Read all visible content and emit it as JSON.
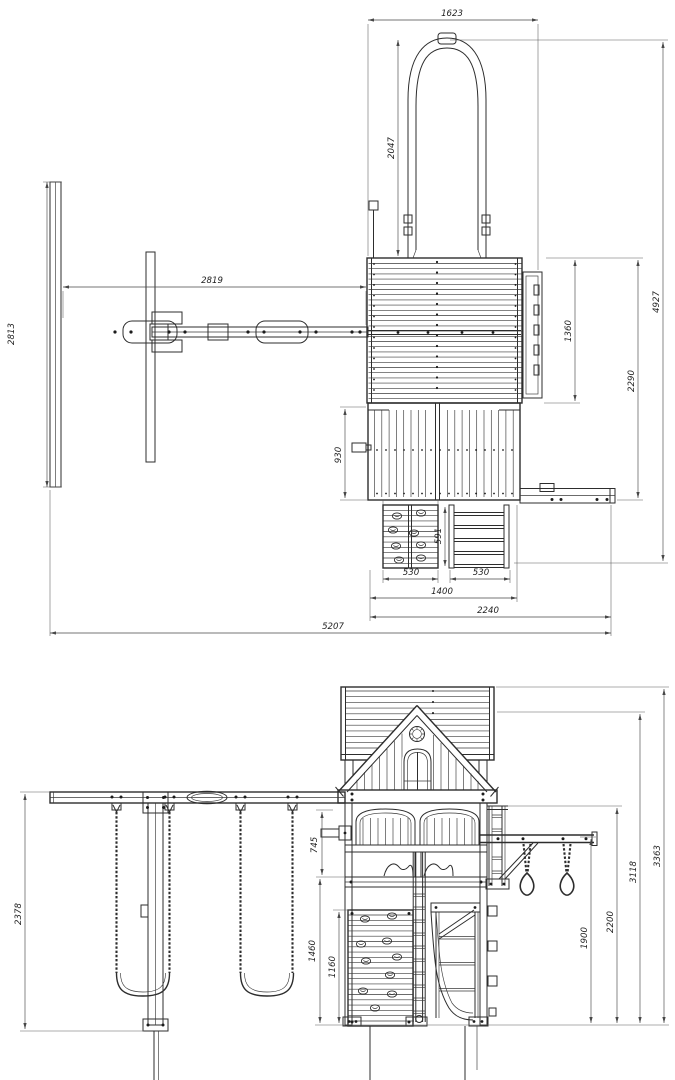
{
  "drawing": {
    "type": "technical-dimension-drawing",
    "subject": "wooden playset with swings, tower, slide, rock wall and monkey bar",
    "units": "mm",
    "line_color": "#2d2d2d",
    "background": "#ffffff",
    "top_view": {
      "name": "plan-view",
      "dims": {
        "slide_width": "1623",
        "slide_length": "2047",
        "beam_span": "2819",
        "aframe_depth": "2813",
        "roof_depth": "1360",
        "tower_depth": "2290",
        "overall_depth": "4927",
        "porch_depth": "930",
        "ladder_depth": "591",
        "rockwall_width": "530",
        "ladder_width": "530",
        "access_width": "1400",
        "tower_width": "2240",
        "overall_width": "5207"
      }
    },
    "front_view": {
      "name": "front-elevation",
      "dims": {
        "aframe_height": "2378",
        "rail_height": "745",
        "deck_height": "1460",
        "rockwall_height": "1160",
        "monkeybar_height": "1900",
        "beam_height": "2200",
        "gable_peak_height": "3118",
        "overall_height": "3363"
      }
    }
  }
}
